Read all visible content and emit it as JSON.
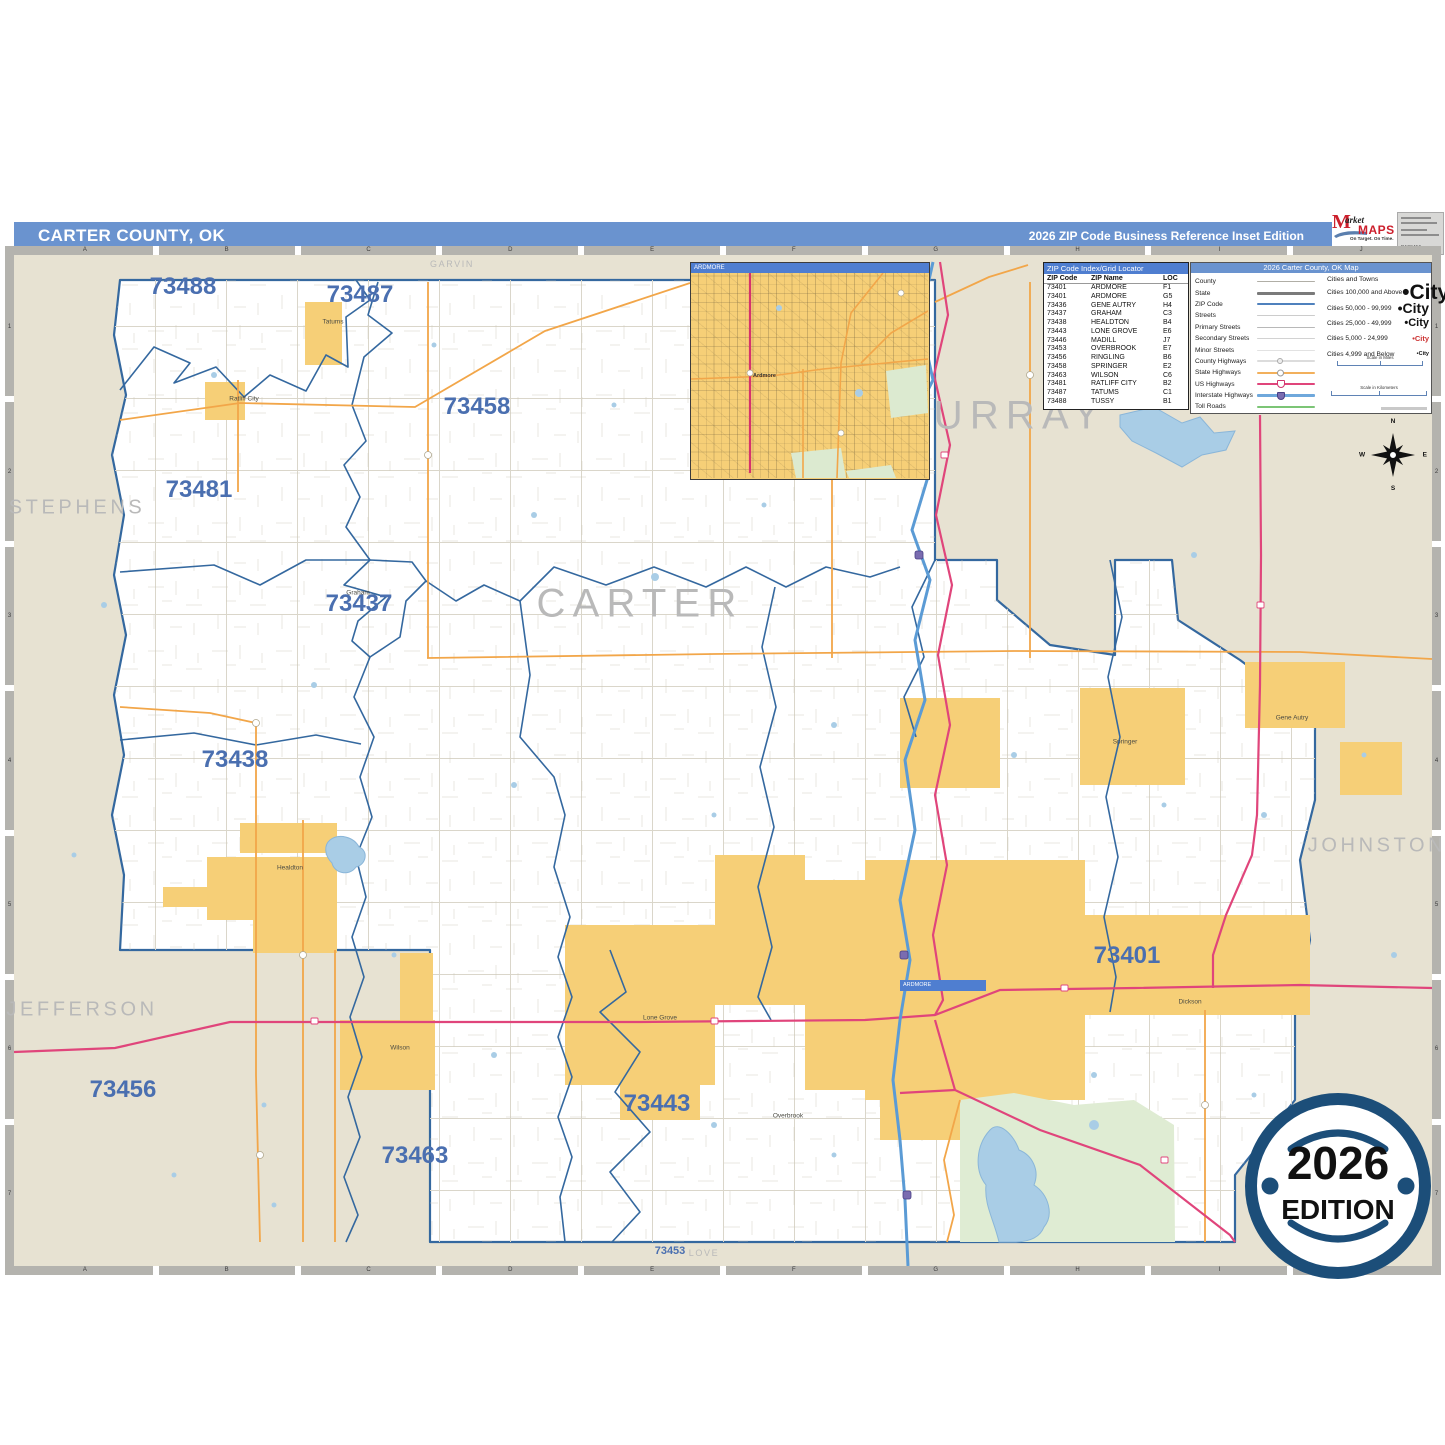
{
  "header": {
    "title": "CARTER COUNTY, OK",
    "edition": "2026 ZIP Code Business Reference Inset Edition"
  },
  "logo": {
    "brand_m": "M",
    "brand_arket": "arket",
    "brand_maps": "MAPS",
    "tagline": "On Target.  On Time.",
    "subtitle": "America's Leading Source of Business Maps",
    "code": "D123456"
  },
  "colors": {
    "header_blue": "#6a93cf",
    "panel_blue": "#4f7ed0",
    "zip_label_blue": "#4a6fb0",
    "county_gray": "#b9b9b9",
    "city_fill_yellow": "#f6cf77",
    "out_of_county_beige": "#e7e2d2",
    "zip_boundary_blue": "#34689f",
    "state_hwy_orange": "#f2a649",
    "us_hwy_pink": "#e0457b",
    "interstate_blue": "#5b9bd5",
    "lake_blue": "#a9cde6",
    "park_green": "#dfecd3",
    "badge_blue": "#1c4e79"
  },
  "map": {
    "grid": {
      "cols": [
        "A",
        "B",
        "C",
        "D",
        "E",
        "F",
        "G",
        "H",
        "I",
        "J"
      ],
      "rows": [
        "1",
        "2",
        "3",
        "4",
        "5",
        "6",
        "7"
      ]
    },
    "inset_title": "ARDMORE",
    "inset_city": "Ardmore",
    "inset_marker_label": "ARDMORE",
    "county_labels": [
      {
        "name": "STEPHENS",
        "x": 77,
        "y": 508,
        "s": 20
      },
      {
        "name": "MURRAY",
        "x": 1000,
        "y": 416,
        "s": 40
      },
      {
        "name": "CARTER",
        "x": 640,
        "y": 604,
        "s": 40
      },
      {
        "name": "JOHNSTON",
        "x": 1377,
        "y": 846,
        "s": 20
      },
      {
        "name": "JEFFERSON",
        "x": 82,
        "y": 1010,
        "s": 20
      },
      {
        "name": "GARVIN",
        "x": 452,
        "y": 264,
        "s": 9
      },
      {
        "name": "LOVE",
        "x": 704,
        "y": 1253,
        "s": 9
      }
    ],
    "zip_labels": [
      {
        "code": "73488",
        "x": 183,
        "y": 287,
        "s": 24
      },
      {
        "code": "73487",
        "x": 360,
        "y": 295,
        "s": 24
      },
      {
        "code": "73458",
        "x": 477,
        "y": 407,
        "s": 24
      },
      {
        "code": "73481",
        "x": 199,
        "y": 490,
        "s": 24
      },
      {
        "code": "73437",
        "x": 359,
        "y": 604,
        "s": 24
      },
      {
        "code": "73438",
        "x": 235,
        "y": 760,
        "s": 24
      },
      {
        "code": "73456",
        "x": 123,
        "y": 1090,
        "s": 24
      },
      {
        "code": "73463",
        "x": 415,
        "y": 1156,
        "s": 24
      },
      {
        "code": "73443",
        "x": 657,
        "y": 1104,
        "s": 24
      },
      {
        "code": "73401",
        "x": 1127,
        "y": 956,
        "s": 24
      },
      {
        "code": "73453",
        "x": 670,
        "y": 1251,
        "s": 11
      }
    ],
    "city_labels": [
      {
        "name": "Tatums",
        "x": 333,
        "y": 322
      },
      {
        "name": "Ratliff City",
        "x": 244,
        "y": 399
      },
      {
        "name": "Graham",
        "x": 358,
        "y": 593
      },
      {
        "name": "Healdton",
        "x": 290,
        "y": 868
      },
      {
        "name": "Wilson",
        "x": 400,
        "y": 1048
      },
      {
        "name": "Lone Grove",
        "x": 660,
        "y": 1018
      },
      {
        "name": "Springer",
        "x": 1125,
        "y": 742
      },
      {
        "name": "Gene Autry",
        "x": 1292,
        "y": 718
      },
      {
        "name": "Dickson",
        "x": 1190,
        "y": 1002
      },
      {
        "name": "Overbrook",
        "x": 788,
        "y": 1116
      }
    ]
  },
  "zip_index": {
    "title": "ZIP Code Index/Grid Locator",
    "columns": [
      "ZIP Code",
      "ZIP Name",
      "LOC"
    ],
    "rows": [
      [
        "73401",
        "ARDMORE",
        "F1"
      ],
      [
        "73401",
        "ARDMORE",
        "G5"
      ],
      [
        "73436",
        "GENE AUTRY",
        "H4"
      ],
      [
        "73437",
        "GRAHAM",
        "C3"
      ],
      [
        "73438",
        "HEALDTON",
        "B4"
      ],
      [
        "73443",
        "LONE GROVE",
        "E6"
      ],
      [
        "73446",
        "MADILL",
        "J7"
      ],
      [
        "73453",
        "OVERBROOK",
        "E7"
      ],
      [
        "73456",
        "RINGLING",
        "B6"
      ],
      [
        "73458",
        "SPRINGER",
        "E2"
      ],
      [
        "73463",
        "WILSON",
        "C6"
      ],
      [
        "73481",
        "RATLIFF CITY",
        "B2"
      ],
      [
        "73487",
        "TATUMS",
        "C1"
      ],
      [
        "73488",
        "TUSSY",
        "B1"
      ]
    ]
  },
  "legend": {
    "title": "2026 Carter County, OK Map",
    "line_items": [
      {
        "label": "County",
        "color": "#b0aea6",
        "h": 1.5
      },
      {
        "label": "State",
        "color": "#7a7a7a",
        "h": 3
      },
      {
        "label": "ZIP Code",
        "color": "#4f81bd",
        "h": 2
      },
      {
        "label": "Streets",
        "color": "#cccccc",
        "h": 1
      },
      {
        "label": "Primary Streets",
        "color": "#b8b8b8",
        "h": 1.5
      },
      {
        "label": "Secondary Streets",
        "color": "#d2d2d2",
        "h": 1
      },
      {
        "label": "Minor Streets",
        "color": "#e2e2e2",
        "h": 1
      },
      {
        "label": "County Highways",
        "color": "#dcdcdc",
        "h": 2,
        "marker": "circle-gray"
      },
      {
        "label": "State Highways",
        "color": "#f2b05c",
        "h": 2.5,
        "marker": "circle"
      },
      {
        "label": "US Highways",
        "color": "#e0457b",
        "h": 2.5,
        "marker": "shield"
      },
      {
        "label": "Interstate Highways",
        "color": "#6fa8dc",
        "h": 3,
        "marker": "ishield"
      },
      {
        "label": "Toll Roads",
        "color": "#7cc576",
        "h": 2
      }
    ],
    "cities_header": "Cities and Towns",
    "city_sample": "City",
    "city_classes": [
      {
        "label": "Cities 100,000 and Above",
        "fs": 21
      },
      {
        "label": "Cities 50,000 - 99,999",
        "fs": 14
      },
      {
        "label": "Cities 25,000 - 49,999",
        "fs": 11
      },
      {
        "label": "Cities 5,000 - 24,999",
        "fs": 7.5,
        "color": "#cc3333"
      },
      {
        "label": "Cities 4,999 and Below",
        "fs": 5.5
      }
    ],
    "scale_miles": "Scale in Miles",
    "scale_km": "Scale in Kilometers"
  },
  "compass": {
    "n": "N",
    "e": "E",
    "s": "S",
    "w": "W"
  },
  "badge": {
    "year": "2026",
    "word": "EDITION"
  }
}
